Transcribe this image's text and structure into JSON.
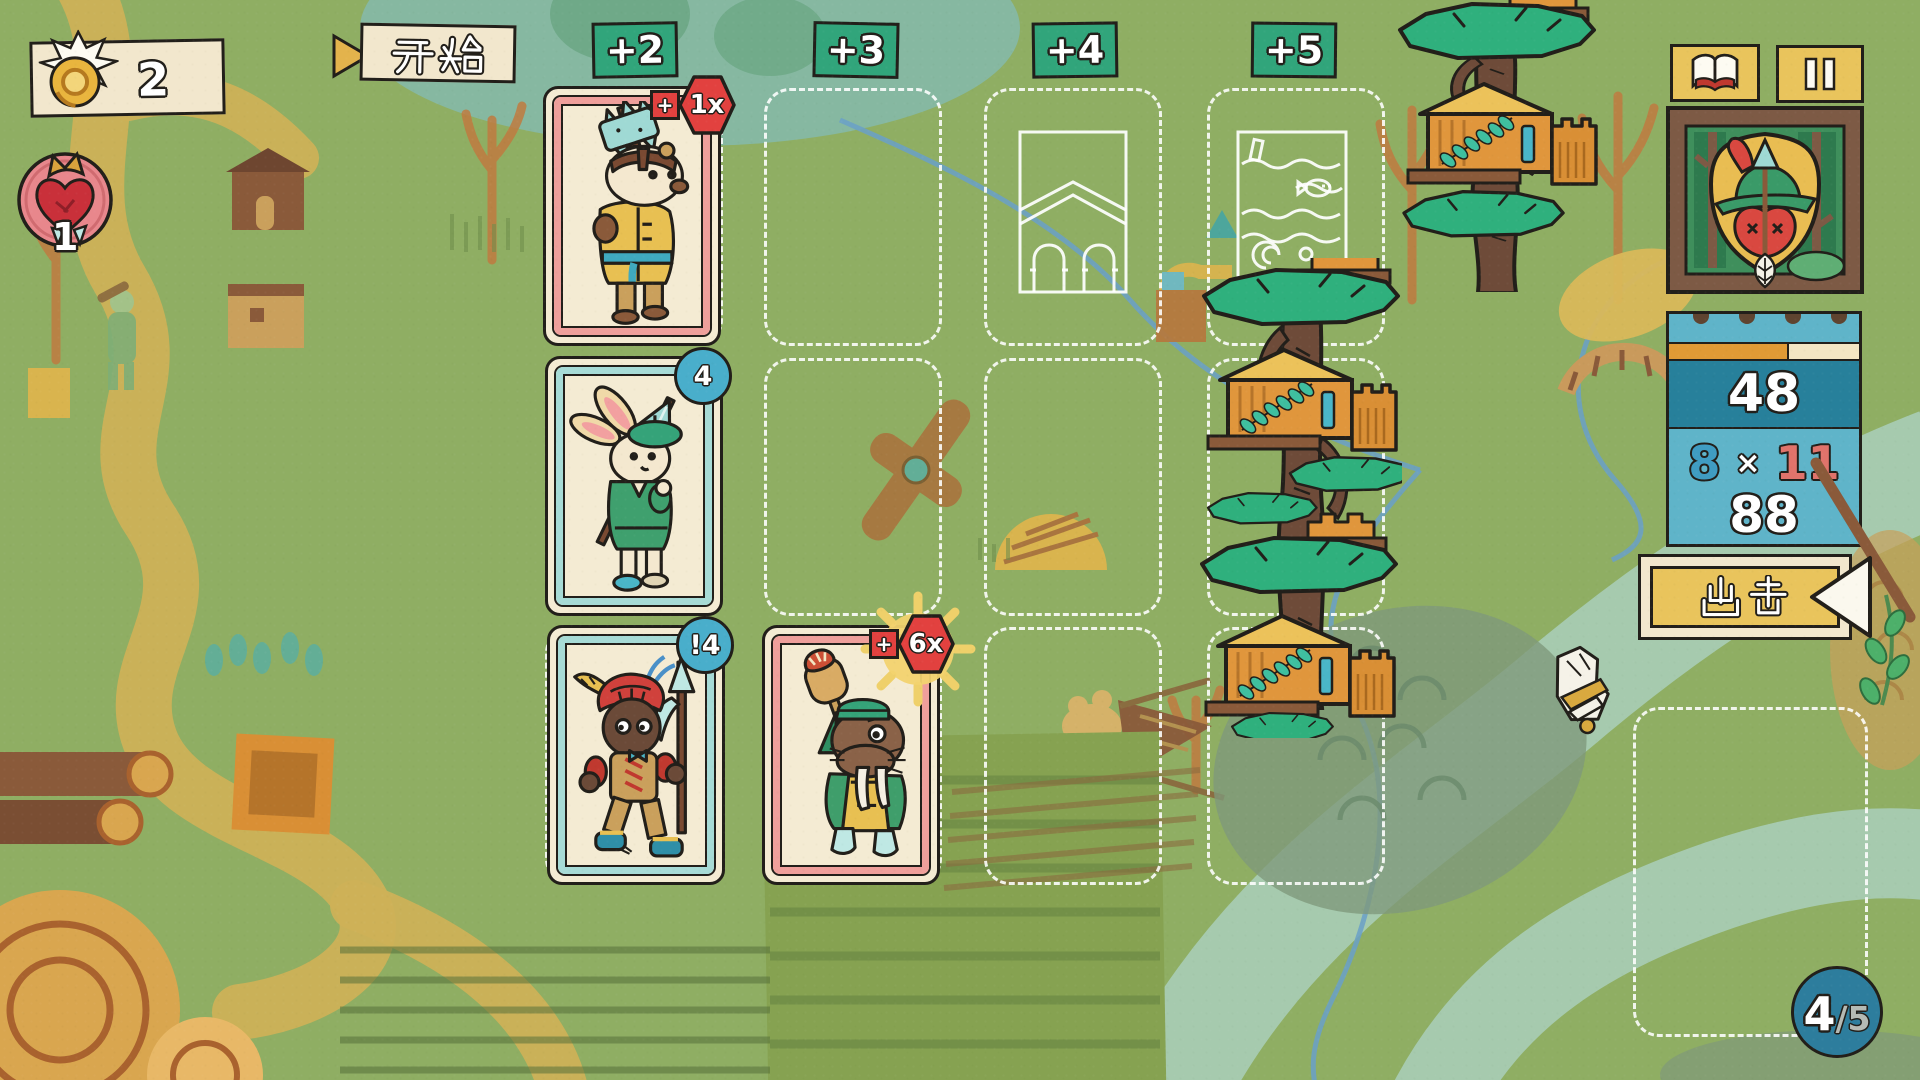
{
  "hud": {
    "gold": {
      "icon": "coin-icon",
      "value": "2"
    },
    "lives": {
      "icon": "heart-crown-icon",
      "value": "1"
    },
    "start": {
      "icon": "play-triangle-icon",
      "label": "开始"
    },
    "wave": {
      "current": "4",
      "total": "/5"
    }
  },
  "board": {
    "columns": [
      {
        "label": "+2"
      },
      {
        "label": "+3"
      },
      {
        "label": "+4"
      },
      {
        "label": "+5"
      }
    ],
    "cards": [
      {
        "id": "badger-soldier",
        "badge_plus": "+",
        "badge_value": "1x",
        "badge_style": "red-hexagon",
        "frame": "pink"
      },
      {
        "id": "rabbit-spearman",
        "badge_value": "4",
        "badge_style": "blue-circle",
        "frame": "teal"
      },
      {
        "id": "mole-halberdier",
        "badge_value": "!4",
        "badge_style": "blue-circle",
        "frame": "teal"
      },
      {
        "id": "walrus-baker",
        "badge_plus": "+",
        "badge_value": "6x",
        "badge_style": "red-hexagon-sunburst",
        "frame": "pink"
      }
    ],
    "blueprints": [
      {
        "id": "bridge-blueprint"
      },
      {
        "id": "river-blueprint"
      }
    ],
    "towers": [
      {
        "id": "treehouse-tower-top"
      },
      {
        "id": "treehouse-tower-middle"
      }
    ]
  },
  "panel": {
    "book_button": {
      "icon": "book-icon"
    },
    "pause_button": {
      "icon": "pause-icon"
    },
    "crest": {
      "id": "apple-arrow-crest"
    },
    "stats": {
      "total": "48",
      "factor_left": "8",
      "times": "×",
      "factor_right": "11",
      "product": "88"
    },
    "attack": {
      "label": "出击",
      "icon": "left-arrow-icon"
    }
  },
  "colors": {
    "background": "#8fae63",
    "header_green": "#31a57b",
    "card_cream": "#f4ebd3",
    "frame_pink": "#ef9f9b",
    "frame_teal": "#a7dbd6",
    "badge_red": "#e2413f",
    "badge_blue": "#49aecb",
    "panel_blue": "#5fb4c9",
    "panel_blue_dark": "#27809b",
    "gold": "#e9c45c",
    "accent_red": "#e0736b",
    "accent_blue": "#3f9cc2"
  }
}
